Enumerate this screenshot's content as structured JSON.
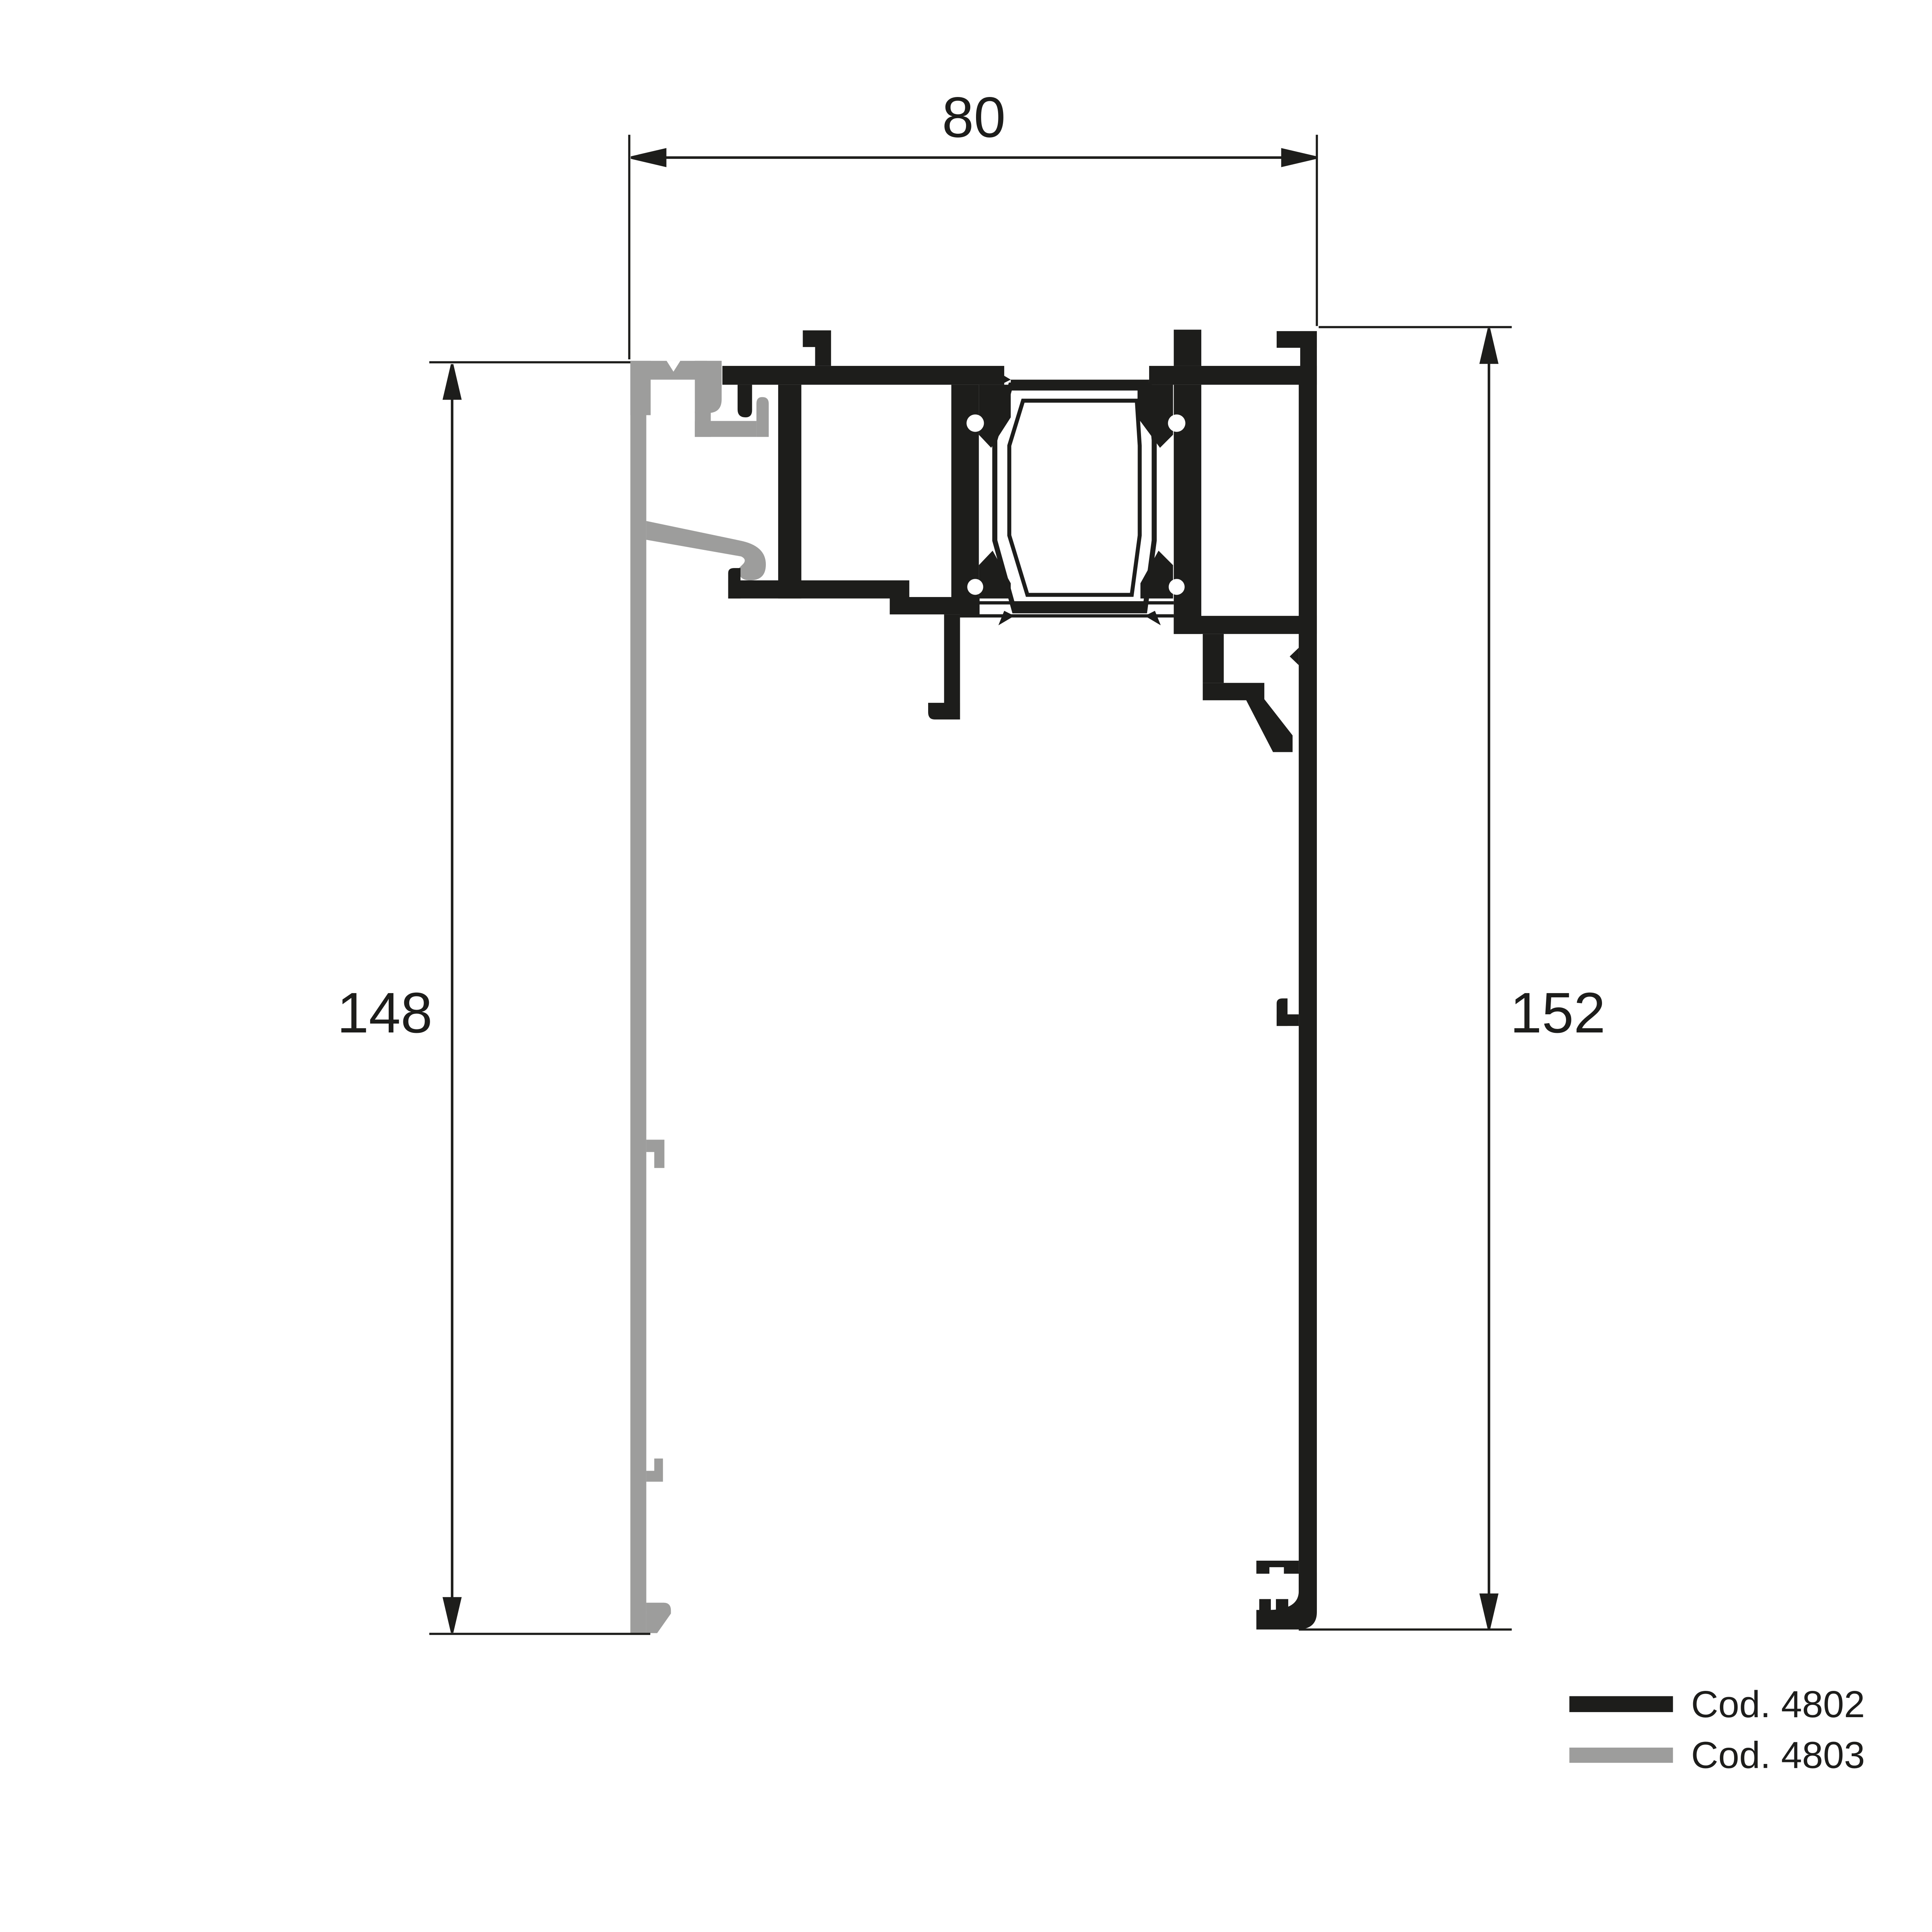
{
  "diagram": {
    "kind": "aluminium-profile-cross-section",
    "background": "#ffffff"
  },
  "dimensions": {
    "top_width": {
      "value": "80"
    },
    "left_height": {
      "value": "148"
    },
    "right_height": {
      "value": "152"
    }
  },
  "legend": {
    "items": [
      {
        "code": "Cod. 4802",
        "color": "#1d1d1b"
      },
      {
        "code": "Cod. 4803",
        "color": "#9d9d9c"
      }
    ]
  },
  "colors": {
    "profile_black": "#1d1d1b",
    "profile_gray": "#9d9d9c",
    "dimension_lines": "#1d1d1b",
    "background": "#ffffff"
  }
}
